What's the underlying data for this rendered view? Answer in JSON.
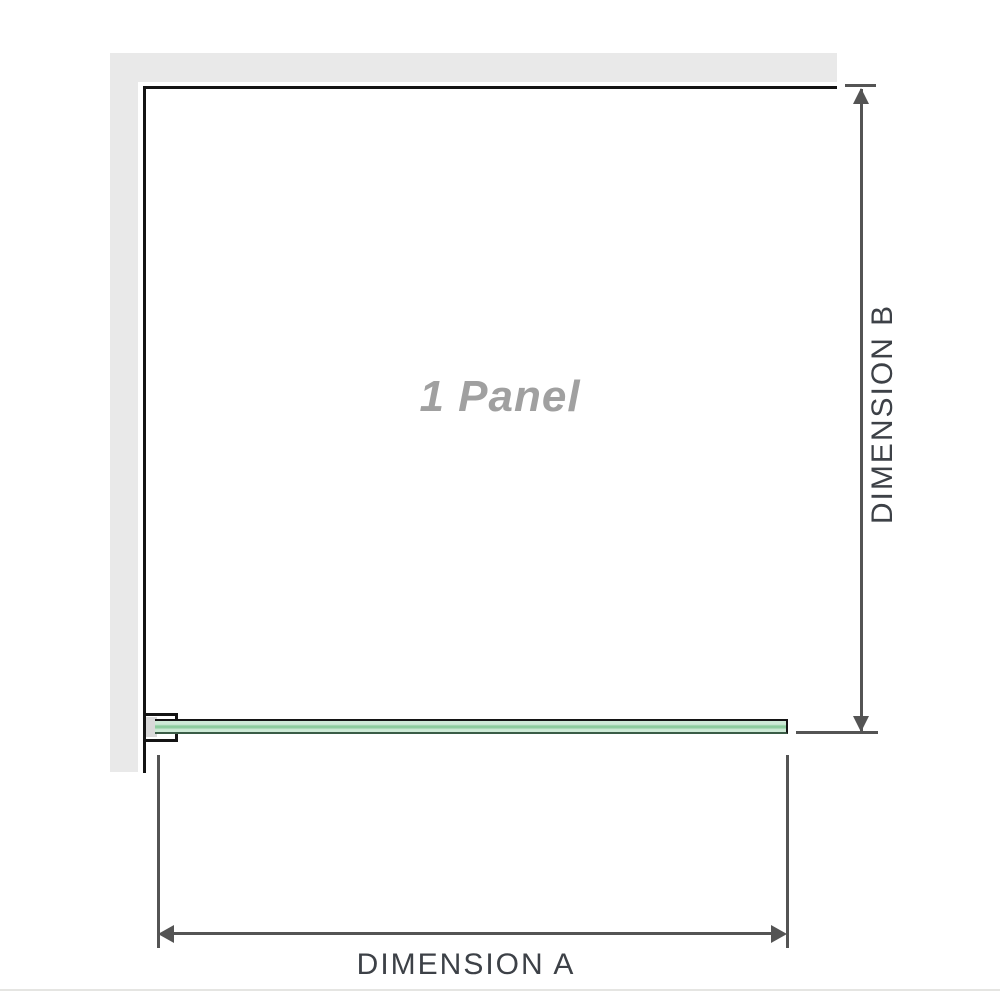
{
  "diagram": {
    "panel_label": "1 Panel",
    "dimension_a_label": "DIMENSION A",
    "dimension_b_label": "DIMENSION B"
  },
  "colors": {
    "wall_fill": "#e9e9e9",
    "outline": "#141414",
    "dim_line": "#545454",
    "dim_text": "#3d4147",
    "panel_text": "#a0a0a0",
    "glass_light": "#cdead6",
    "glass_dark": "#8bcc9d",
    "glass_edge": "#3a5c46",
    "bracket_insert": "#d9d9d9",
    "divider": "#e5e5e2",
    "background": "#ffffff"
  }
}
